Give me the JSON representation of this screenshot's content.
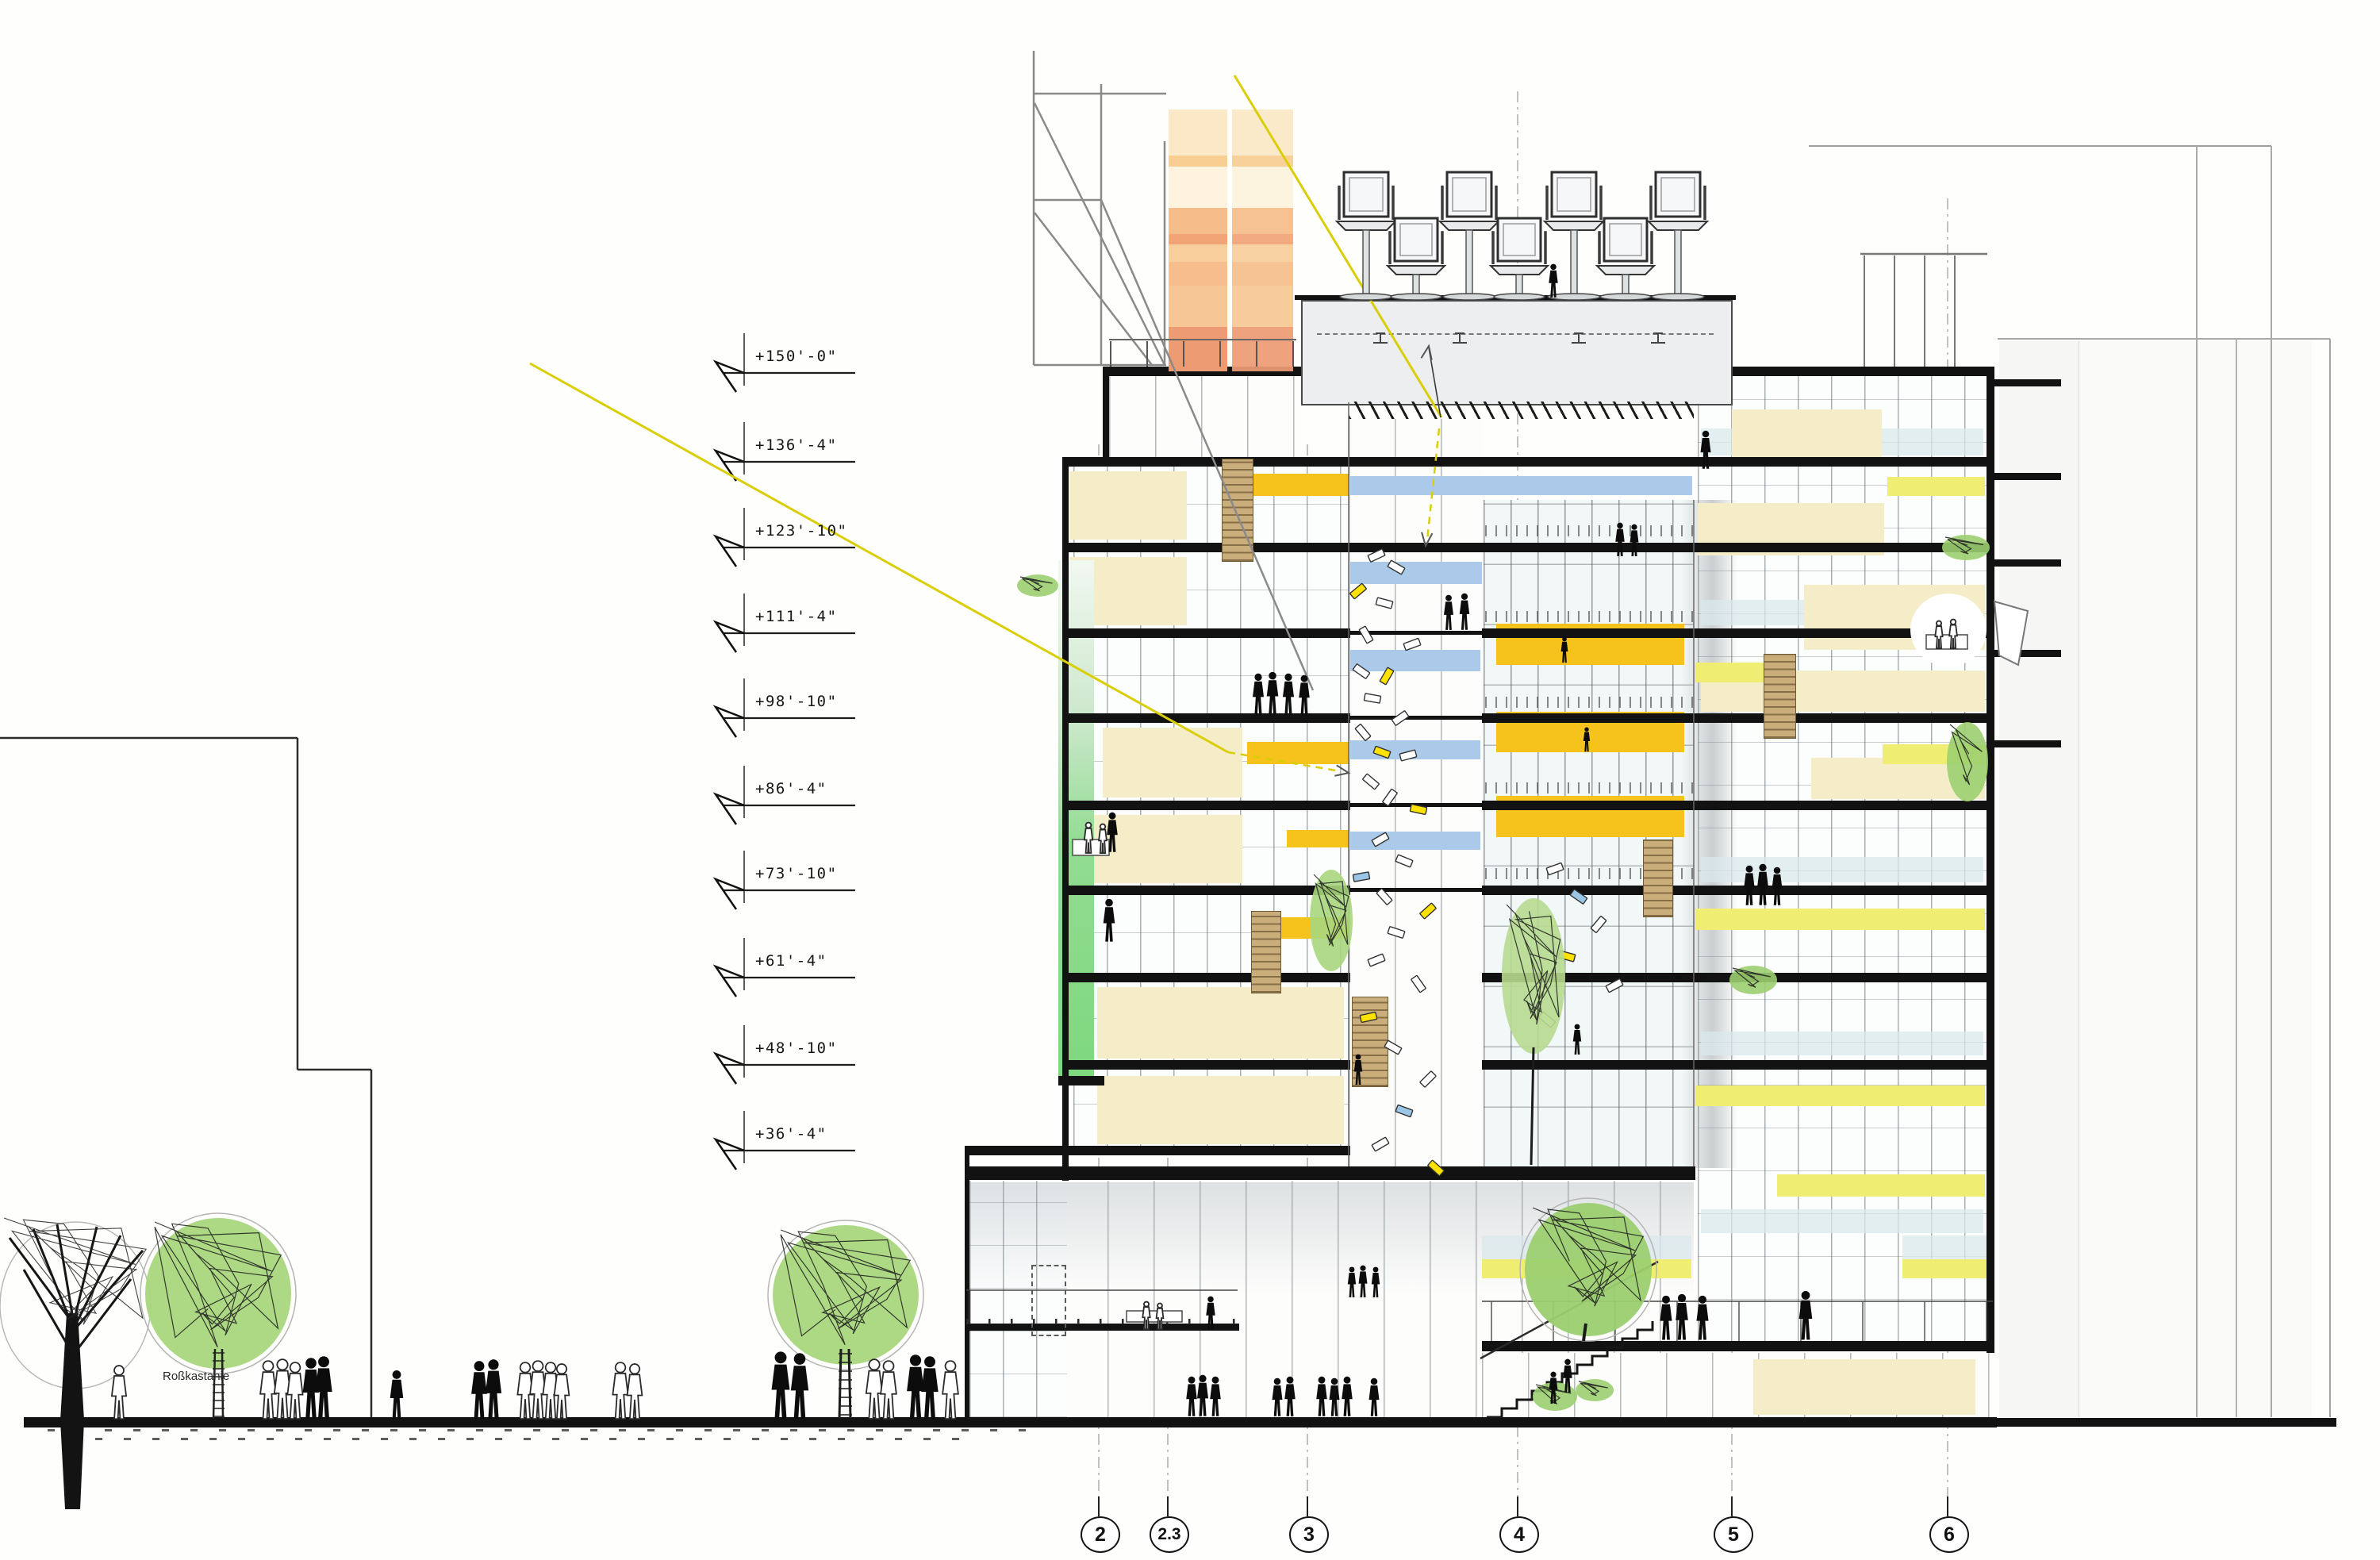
{
  "drawing": {
    "kind": "architectural-building-section",
    "tree_species_label": "Roßkastanie"
  },
  "elevations": [
    {
      "label": "+150'-0\""
    },
    {
      "label": "+136'-4\""
    },
    {
      "label": "+123'-10\""
    },
    {
      "label": "+111'-4\""
    },
    {
      "label": "+98'-10\""
    },
    {
      "label": "+86'-4\""
    },
    {
      "label": "+73'-10\""
    },
    {
      "label": "+61'-4\""
    },
    {
      "label": "+48'-10\""
    },
    {
      "label": "+36'-4\""
    }
  ],
  "grid_bubbles": [
    {
      "label": "2"
    },
    {
      "label": "2.3"
    },
    {
      "label": "3"
    },
    {
      "label": "4"
    },
    {
      "label": "5"
    },
    {
      "label": "6"
    }
  ],
  "colors": {
    "cream": "#F4EDC7",
    "amber": "#F6C31C",
    "lemon": "#EFEE72",
    "blue_band": "#ABC9E8",
    "green_strip": "#82D882",
    "canopy_green": "#A9D77E",
    "stair_tan": "#C9AE7C",
    "sun_ray": "#D9CE08",
    "slab_black": "#121212",
    "orange_block_bands": [
      "#FBE8C6",
      "#F8CE92",
      "#FDF3DE",
      "#F5BD89",
      "#F1A476",
      "#F8CF9C",
      "#F5BE8C",
      "#F6C795",
      "#ED9B73"
    ]
  }
}
